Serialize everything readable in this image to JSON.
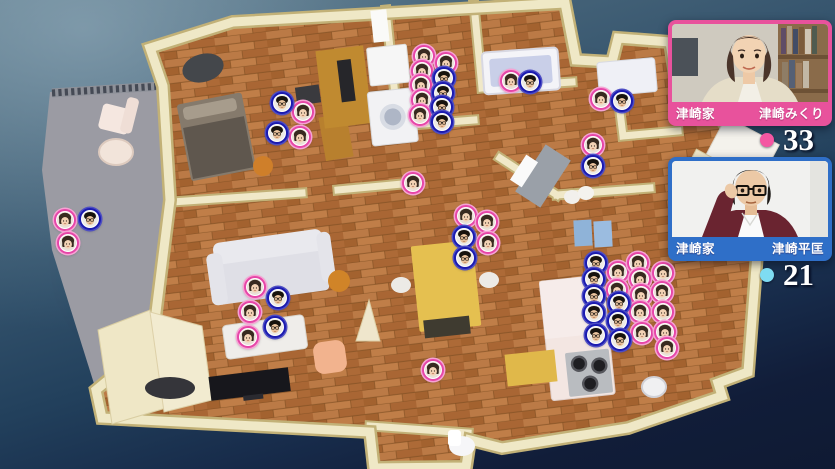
{
  "cards": [
    {
      "id": "mikuri",
      "family_label": "津崎家",
      "person_label": "津崎みくり",
      "count": "33",
      "accent": "#e8529c",
      "dot_color": "#f457a2"
    },
    {
      "id": "hiramasa",
      "family_label": "津崎家",
      "person_label": "津崎平匡",
      "count": "21",
      "accent": "#2f6fc8",
      "dot_color": "#7edcf2"
    }
  ],
  "markers": {
    "pink": [
      [
        424,
        56
      ],
      [
        422,
        71
      ],
      [
        421,
        85
      ],
      [
        422,
        100
      ],
      [
        420,
        115
      ],
      [
        446,
        63
      ],
      [
        511,
        81
      ],
      [
        303,
        112
      ],
      [
        300,
        137
      ],
      [
        601,
        99
      ],
      [
        593,
        145
      ],
      [
        65,
        220
      ],
      [
        68,
        243
      ],
      [
        413,
        183
      ],
      [
        466,
        216
      ],
      [
        487,
        222
      ],
      [
        488,
        243
      ],
      [
        255,
        287
      ],
      [
        250,
        312
      ],
      [
        248,
        337
      ],
      [
        618,
        272
      ],
      [
        617,
        290
      ],
      [
        638,
        263
      ],
      [
        640,
        279
      ],
      [
        641,
        295
      ],
      [
        640,
        312
      ],
      [
        642,
        333
      ],
      [
        663,
        273
      ],
      [
        662,
        292
      ],
      [
        663,
        312
      ],
      [
        665,
        332
      ],
      [
        667,
        348
      ],
      [
        433,
        370
      ]
    ],
    "blue": [
      [
        444,
        78
      ],
      [
        443,
        93
      ],
      [
        442,
        107
      ],
      [
        442,
        122
      ],
      [
        530,
        82
      ],
      [
        282,
        103
      ],
      [
        277,
        133
      ],
      [
        622,
        101
      ],
      [
        593,
        166
      ],
      [
        90,
        219
      ],
      [
        278,
        298
      ],
      [
        275,
        327
      ],
      [
        464,
        237
      ],
      [
        465,
        258
      ],
      [
        596,
        263
      ],
      [
        594,
        279
      ],
      [
        594,
        296
      ],
      [
        594,
        313
      ],
      [
        596,
        335
      ],
      [
        619,
        303
      ],
      [
        618,
        321
      ],
      [
        620,
        340
      ]
    ]
  },
  "colors": {
    "pink_ring": "#e646a8",
    "blue_ring": "#1b1bb0",
    "wall": "#efe8c6",
    "wood": "#b26f3c",
    "background_bottom": "#0f1a33"
  }
}
